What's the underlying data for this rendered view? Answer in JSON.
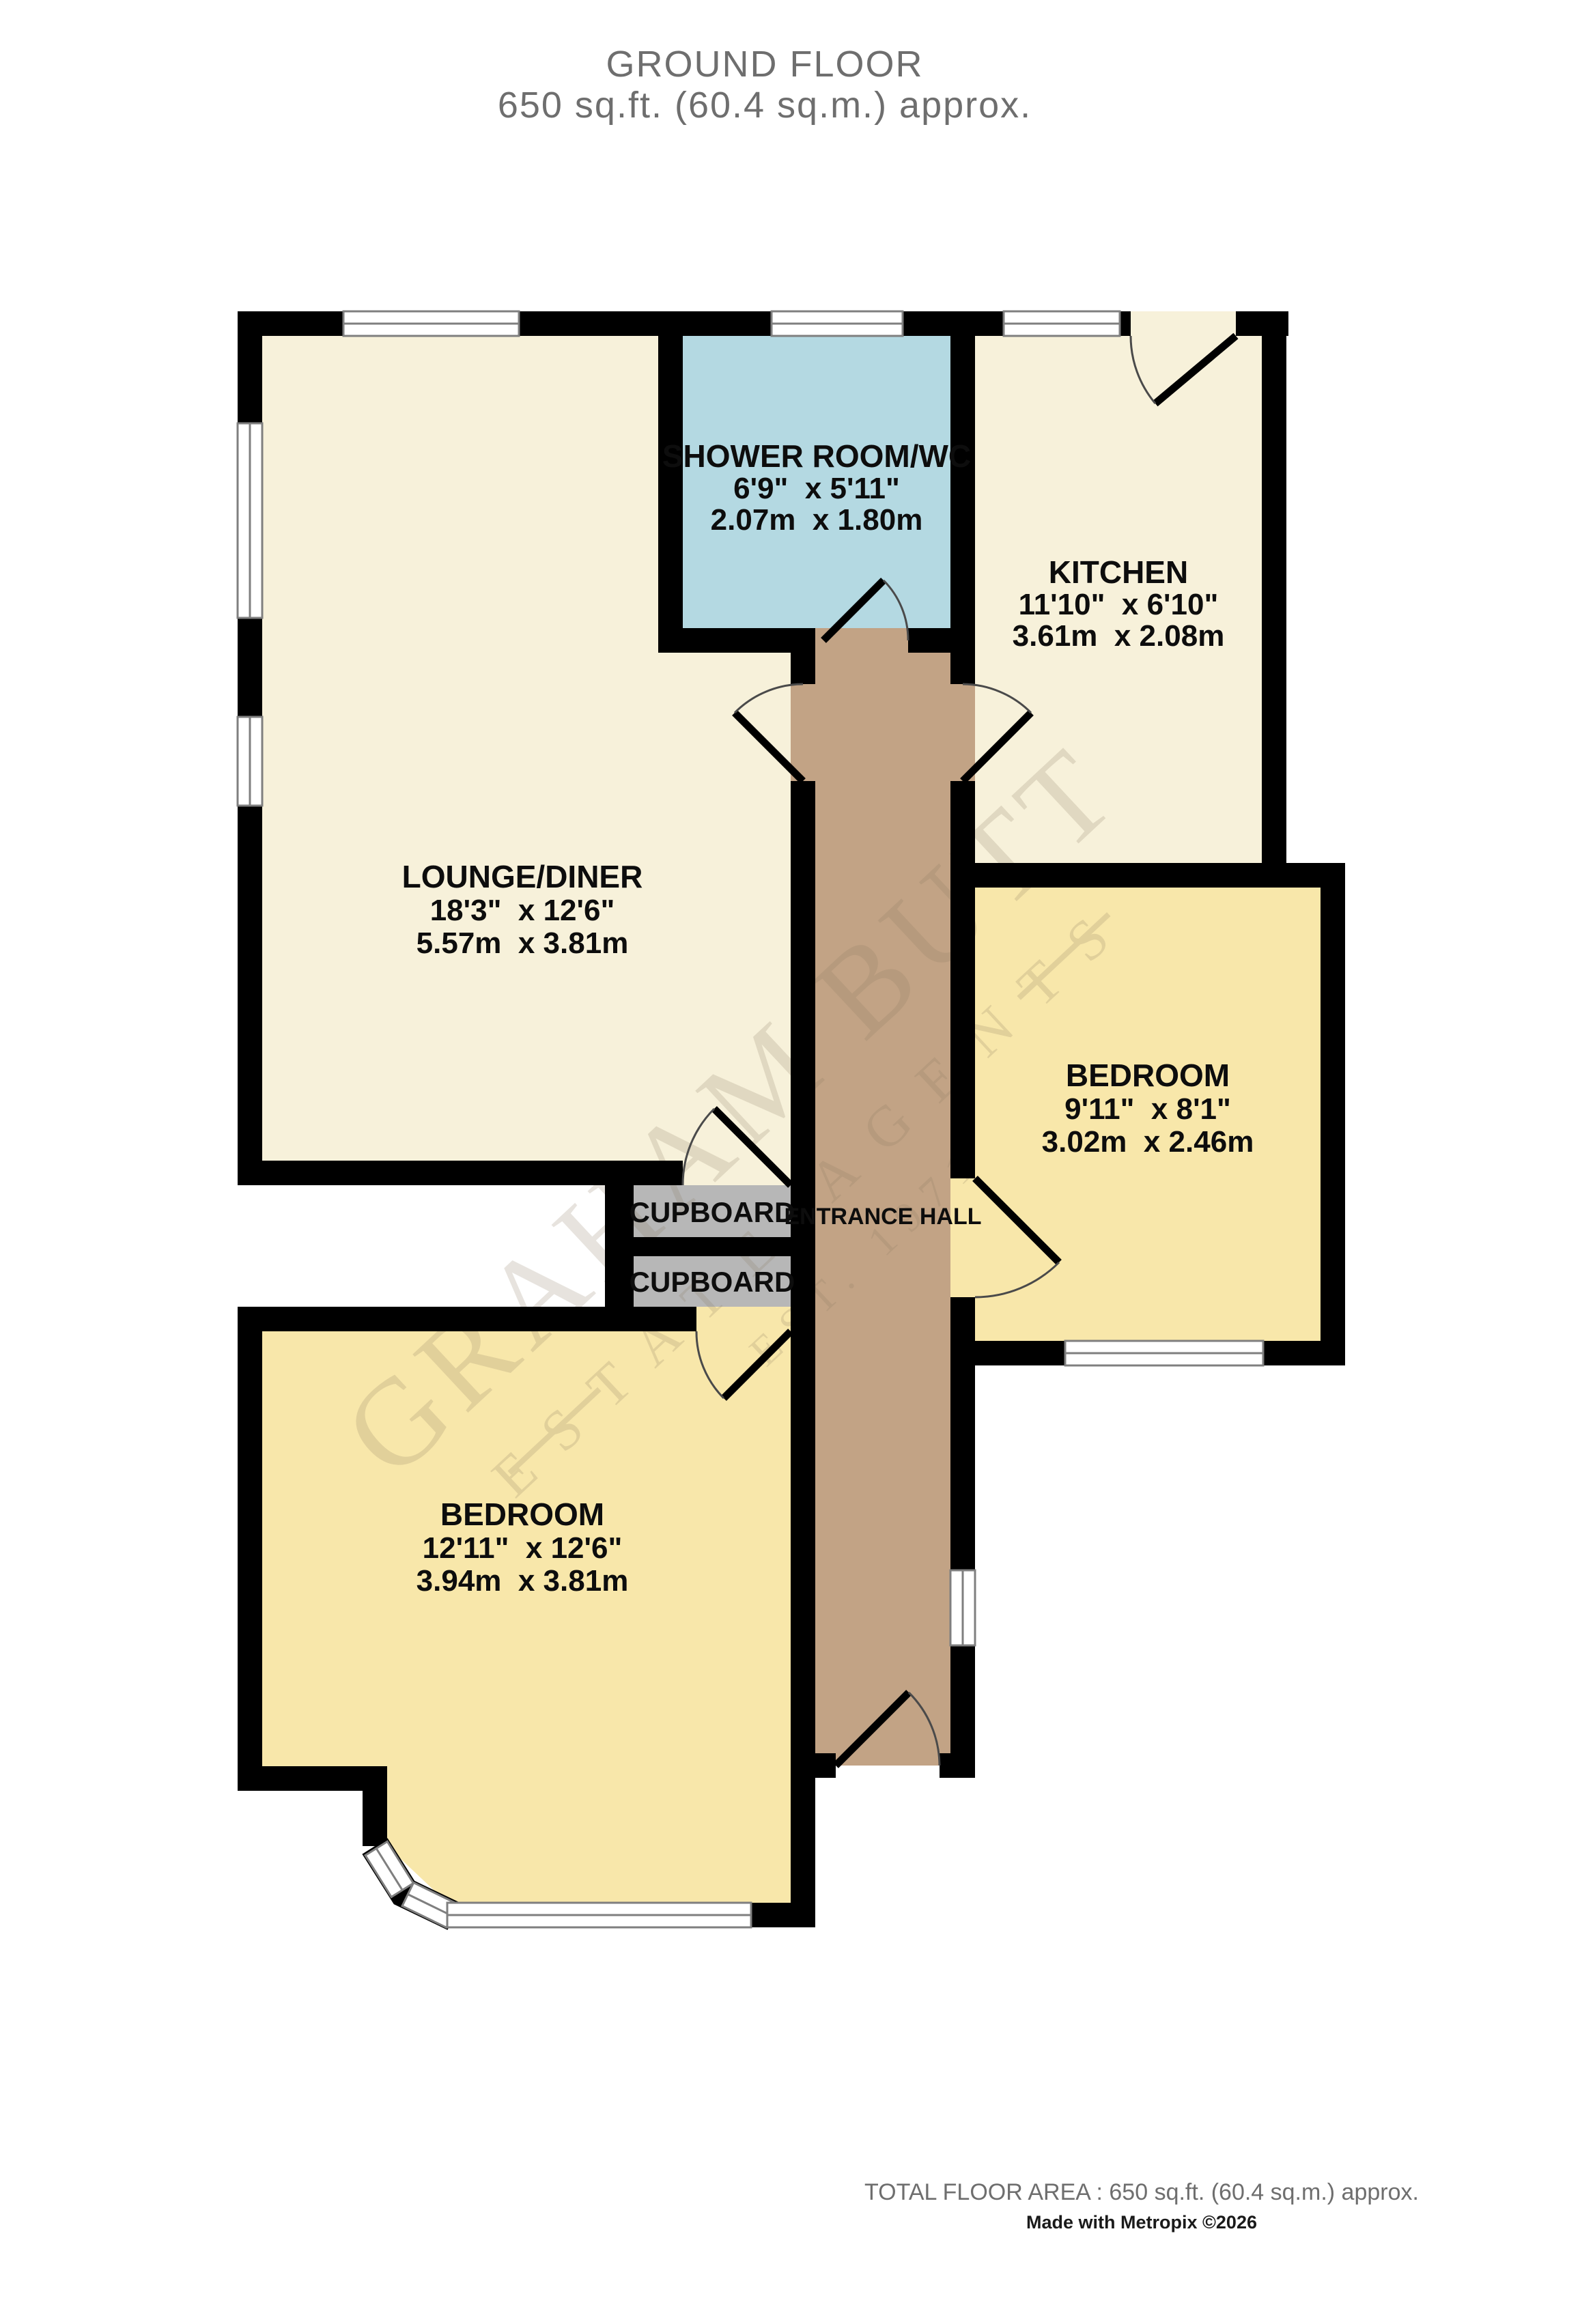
{
  "header": {
    "title": "GROUND FLOOR",
    "subtitle": "650 sq.ft. (60.4 sq.m.) approx."
  },
  "rooms": {
    "shower": {
      "name": "SHOWER ROOM/WC",
      "imperial": "6'9\"  x 5'11\"",
      "metric": "2.07m  x 1.80m"
    },
    "kitchen": {
      "name": "KITCHEN",
      "imperial": "11'10\"  x 6'10\"",
      "metric": "3.61m  x 2.08m"
    },
    "lounge": {
      "name": "LOUNGE/DINER",
      "imperial": "18'3\"  x 12'6\"",
      "metric": "5.57m  x 3.81m"
    },
    "bedroom_right": {
      "name": "BEDROOM",
      "imperial": "9'11\"  x 8'1\"",
      "metric": "3.02m  x 2.46m"
    },
    "bedroom_bottom": {
      "name": "BEDROOM",
      "imperial": "12'11\"  x 12'6\"",
      "metric": "3.94m  x 3.81m"
    },
    "hall": {
      "name": "ENTRANCE HALL"
    },
    "cupboard_top": {
      "name": "CUPBOARD"
    },
    "cupboard_bottom": {
      "name": "CUPBOARD"
    }
  },
  "watermark": {
    "line1": "GRAHAM BUTT",
    "line2": "ESTATE AGENTS",
    "line3": "EST. 1971"
  },
  "footer": {
    "total_area": "TOTAL FLOOR AREA : 650 sq.ft. (60.4 sq.m.) approx.",
    "credit": "Made with Metropix ©2026"
  },
  "colors": {
    "wall": "#000000",
    "cream_room": "#F7F1DA",
    "yellow_room": "#F8E7AA",
    "blue_room": "#B4D9E2",
    "hall": "#C2A385",
    "cupboard": "#B7B7B7",
    "window_frame": "#7F7F7F",
    "heading_text": "#6E6E6E",
    "label_text": "#0D0D0D",
    "watermark": "#8A7A5F"
  }
}
